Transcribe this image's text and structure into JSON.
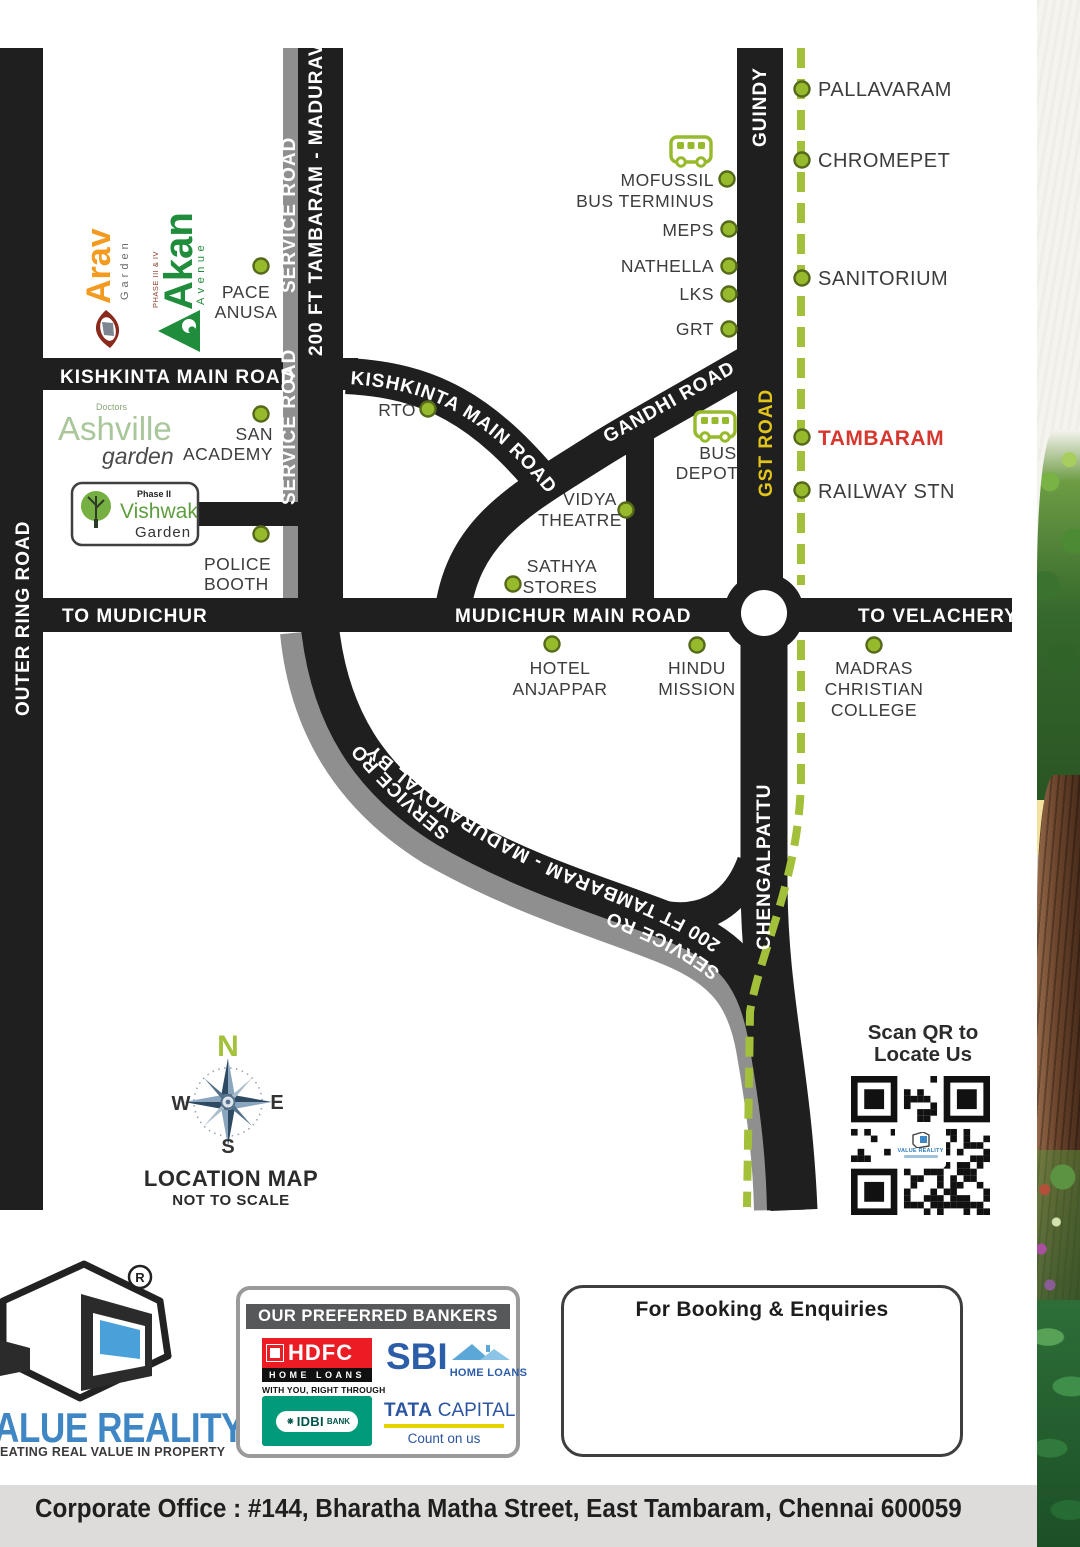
{
  "colors": {
    "road": "#1f1f1f",
    "service_road": "#8f8f8f",
    "green_dot": "#96ba2c",
    "dash_line": "#a3c03a",
    "gst_text": "#e2c51b",
    "tambaram_red": "#d6372f",
    "label_text": "#3c3c3c",
    "brand_blue": "#3f86c5"
  },
  "map": {
    "roads": {
      "outer_ring": "OUTER RING ROAD",
      "kishkinta_main": "KISHKINTA MAIN ROAD",
      "kishkinta_diag": "KISHKINTA MAIN ROAD",
      "bypass_vertical": "200 FT TAMBARAM - MADURAVOYAL BYPASS",
      "bypass_curve": "200 FT TAMBARAM - MADURAVOYAL BYPASS",
      "service_road_top1": "SERVICE ROAD",
      "service_road_top2": "SERVICE ROAD",
      "service_road_curve1": "SERVICE ROAD",
      "service_road_curve2": "SERVICE ROAD",
      "gandhi": "GANDHI ROAD",
      "guindy": "GUINDY",
      "gst": "GST ROAD",
      "to_mudichur": "TO MUDICHUR",
      "mudichur_main": "MUDICHUR MAIN ROAD",
      "to_velachery": "TO VELACHERY",
      "chengalpattu": "CHENGALPATTU"
    },
    "stations": {
      "pallavaram": "PALLAVARAM",
      "chromepet": "CHROMEPET",
      "sanitorium": "SANITORIUM",
      "tambaram": "TAMBARAM",
      "railway": "RAILWAY STN"
    },
    "landmarks": {
      "pace1": "PACE",
      "pace2": "ANUSA",
      "mofussil1": "MOFUSSIL",
      "mofussil2": "BUS TERMINUS",
      "meps": "MEPS",
      "nathella": "NATHELLA",
      "lks": "LKS",
      "grt": "GRT",
      "san1": "SAN",
      "san2": "ACADEMY",
      "rto": "RTO",
      "vidya1": "VIDYA",
      "vidya2": "THEATRE",
      "sathya1": "SATHYA",
      "sathya2": "STORES",
      "bus1": "BUS",
      "bus2": "DEPOT",
      "police1": "POLICE",
      "police2": "BOOTH",
      "hotel1": "HOTEL",
      "hotel2": "ANJAPPAR",
      "hindu1": "HINDU",
      "hindu2": "MISSION",
      "mcc1": "MADRAS",
      "mcc2": "CHRISTIAN",
      "mcc3": "COLLEGE"
    },
    "logos": {
      "arav": {
        "name": "Arav",
        "sub": "Garden"
      },
      "akan": {
        "phase": "PHASE III & IV",
        "name": "Akan",
        "sub": "Avenue"
      },
      "ashville": {
        "top": "Doctors",
        "name": "Ashville",
        "sub": "garden"
      },
      "vishwak": {
        "phase": "Phase II",
        "name": "Vishwak",
        "sub": "Garden"
      }
    },
    "compass": {
      "n": "N",
      "e": "E",
      "s": "S",
      "w": "W",
      "title": "LOCATION MAP",
      "subtitle": "NOT TO SCALE"
    },
    "qr": {
      "line1": "Scan QR to",
      "line2": "Locate Us",
      "brand": "VALUE REALITY"
    }
  },
  "footer": {
    "brand": {
      "reg": "R",
      "name": "ALUE REALITY",
      "tagline": "EATING REAL VALUE IN PROPERTY"
    },
    "bankers": {
      "header": "OUR PREFERRED BANKERS",
      "hdfc": {
        "name": "HDFC",
        "band": "HOME LOANS",
        "tagline": "WITH YOU, RIGHT THROUGH"
      },
      "sbi": {
        "name": "SBI",
        "band": "HOME LOANS"
      },
      "idbi": {
        "name": "IDBI",
        "sub": "BANK",
        "flower": "❋"
      },
      "tata": {
        "name": "TATA",
        "name2": "CAPITAL",
        "tagline": "Count on us"
      }
    },
    "booking": {
      "title": "For Booking & Enquiries"
    },
    "address": "Corporate Office : #144, Bharatha Matha Street, East Tambaram, Chennai 600059"
  }
}
